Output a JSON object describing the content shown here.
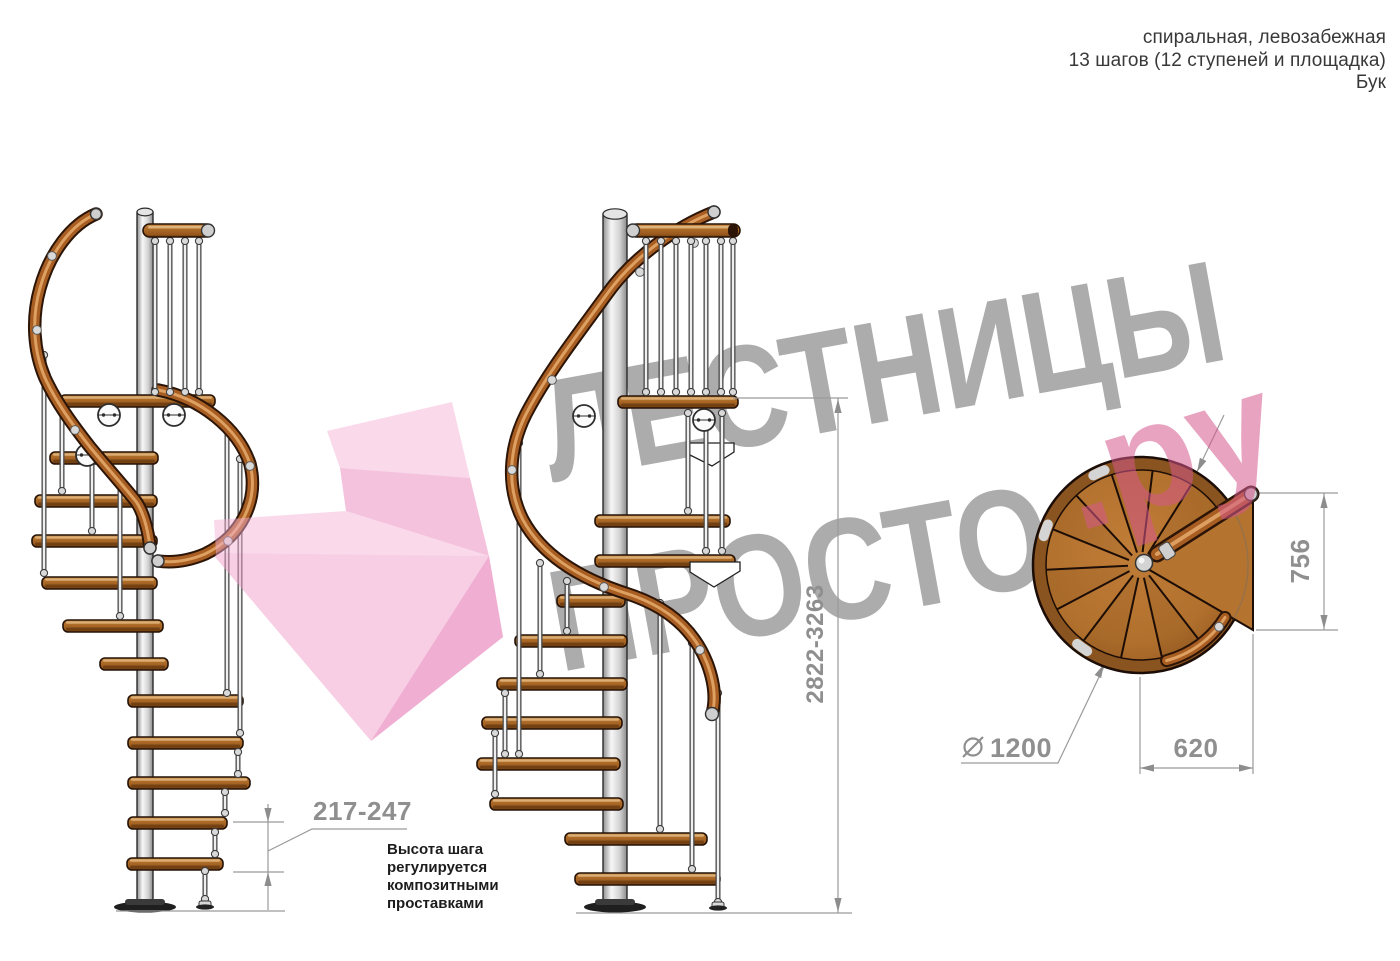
{
  "header": {
    "lines": [
      "спиральная, левозабежная",
      "13 шагов (12 ступеней и площадка)",
      "Бук"
    ]
  },
  "watermark": {
    "line1": "ЛЕСТНИЦЫ",
    "line2": "ПРОСТО",
    "suffix": ".ру"
  },
  "dimensions": {
    "total_height": "2822-3263",
    "step_height": "217-247",
    "platform_depth": "756",
    "platform_width": "620",
    "diameter_symbol": "⌀",
    "diameter": "1200"
  },
  "annotation": {
    "step_height_note": "Высота шага\nрегулируется\nкомпозитными\nпроставками"
  },
  "colors": {
    "wood": "#a85e22",
    "metal": "#d6d6d6",
    "dimension_gray": "#8f8f8f",
    "watermark_gray": "#ababab",
    "watermark_pink": "#e8a3c0",
    "arrow_pink": "#f3b8d8"
  }
}
